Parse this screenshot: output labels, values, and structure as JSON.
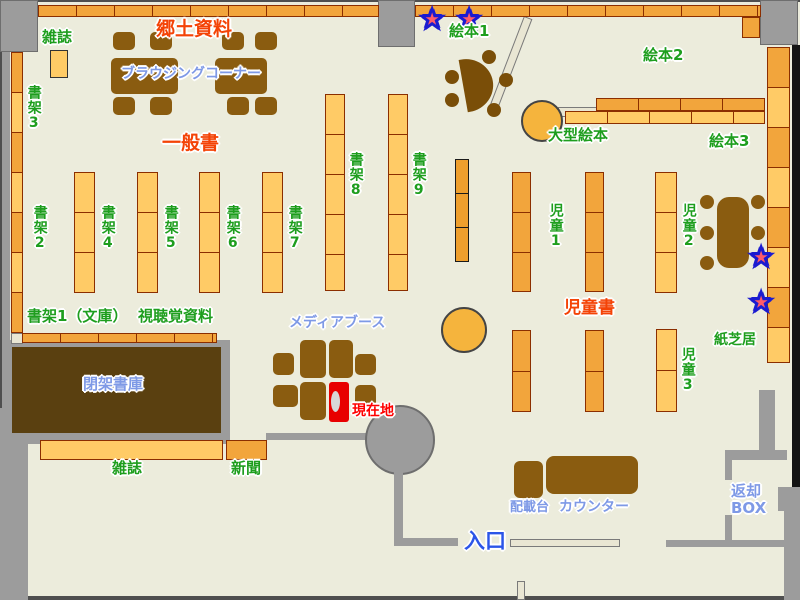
{
  "map": {
    "type": "library-floor-map"
  },
  "labels": {
    "magazines_top": "雑誌",
    "local_materials": "郷土資料",
    "browsing_corner": "ブラウジングコーナー",
    "general_books": "一般書",
    "shelf_3": "書架3",
    "shelf_2": "書架2",
    "shelf_4": "書架4",
    "shelf_5": "書架5",
    "shelf_6": "書架6",
    "shelf_7": "書架7",
    "shelf_8": "書架8",
    "shelf_9": "書架9",
    "shelf_1_bunko": "書架1（文庫）",
    "av_materials": "視聴覚資料",
    "media_booth": "メディアブース",
    "current_location": "現在地",
    "closed_stacks": "閉架書庫",
    "magazines_bottom": "雑誌",
    "newspaper": "新聞",
    "entrance": "入口",
    "picture_books_1": "絵本1",
    "picture_books_2": "絵本2",
    "picture_books_3": "絵本3",
    "large_picture_books": "大型絵本",
    "children_1": "児童1",
    "children_2": "児童2",
    "children_3": "児童3",
    "children_books": "児童書",
    "kamishibai": "紙芝居",
    "loading_stand": "配載台",
    "counter": "カウンター",
    "return_box": "返却BOX"
  },
  "icons": {
    "star": "★"
  },
  "colors": {
    "floor": "#ECECDC",
    "shelf_dark": "#F2A53C",
    "shelf_light": "#FFCB66",
    "shelf_border": "#8B2E00",
    "furniture_brown": "#8A5C10",
    "closed_stacks_brown": "#5A4010",
    "wall_gray": "#9C9C9C",
    "label_green": "#1E9E1E",
    "label_red": "#F44306",
    "label_blue": "#7E99E6",
    "entrance_blue": "#2B55E8",
    "current_location_red": "#FF0000",
    "booth_red": "#E80000",
    "star_fill": "#FF5B6A",
    "star_outline": "#1B1BD0"
  }
}
